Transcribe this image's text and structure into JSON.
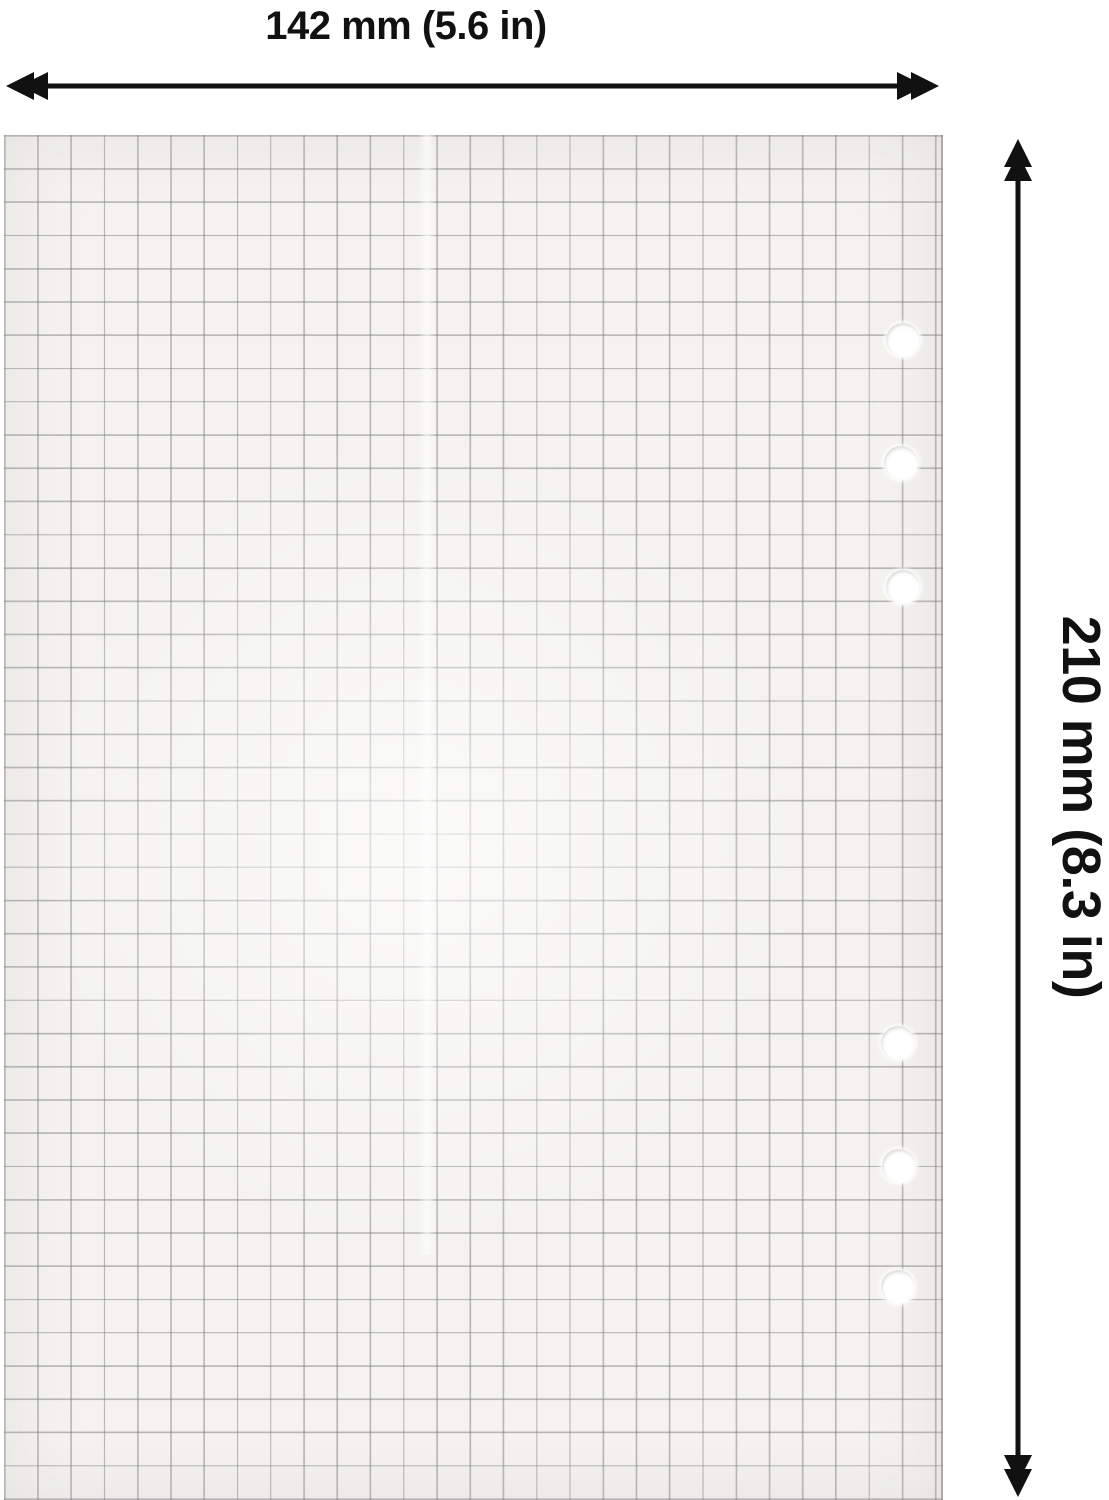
{
  "image_type": "product-dimension-diagram",
  "annotations": {
    "width_label": "142 mm (5.6 in)",
    "height_label": "210 mm (8.3 in)"
  },
  "colors": {
    "annotation": "#111111",
    "background": "#ffffff",
    "paper": "#f4f3f0",
    "grid_line": "#bdbdbf"
  },
  "paper": {
    "style": "5mm-square-grid-refill-sheet",
    "grid_cell_px": 33.25,
    "hole_count": 6,
    "hole_diameter_px": 34,
    "holes": [
      {
        "cx": 903,
        "cy": 340
      },
      {
        "cx": 901,
        "cy": 463
      },
      {
        "cx": 903,
        "cy": 587
      },
      {
        "cx": 898,
        "cy": 1043
      },
      {
        "cx": 899,
        "cy": 1166
      },
      {
        "cx": 898,
        "cy": 1287
      }
    ]
  }
}
